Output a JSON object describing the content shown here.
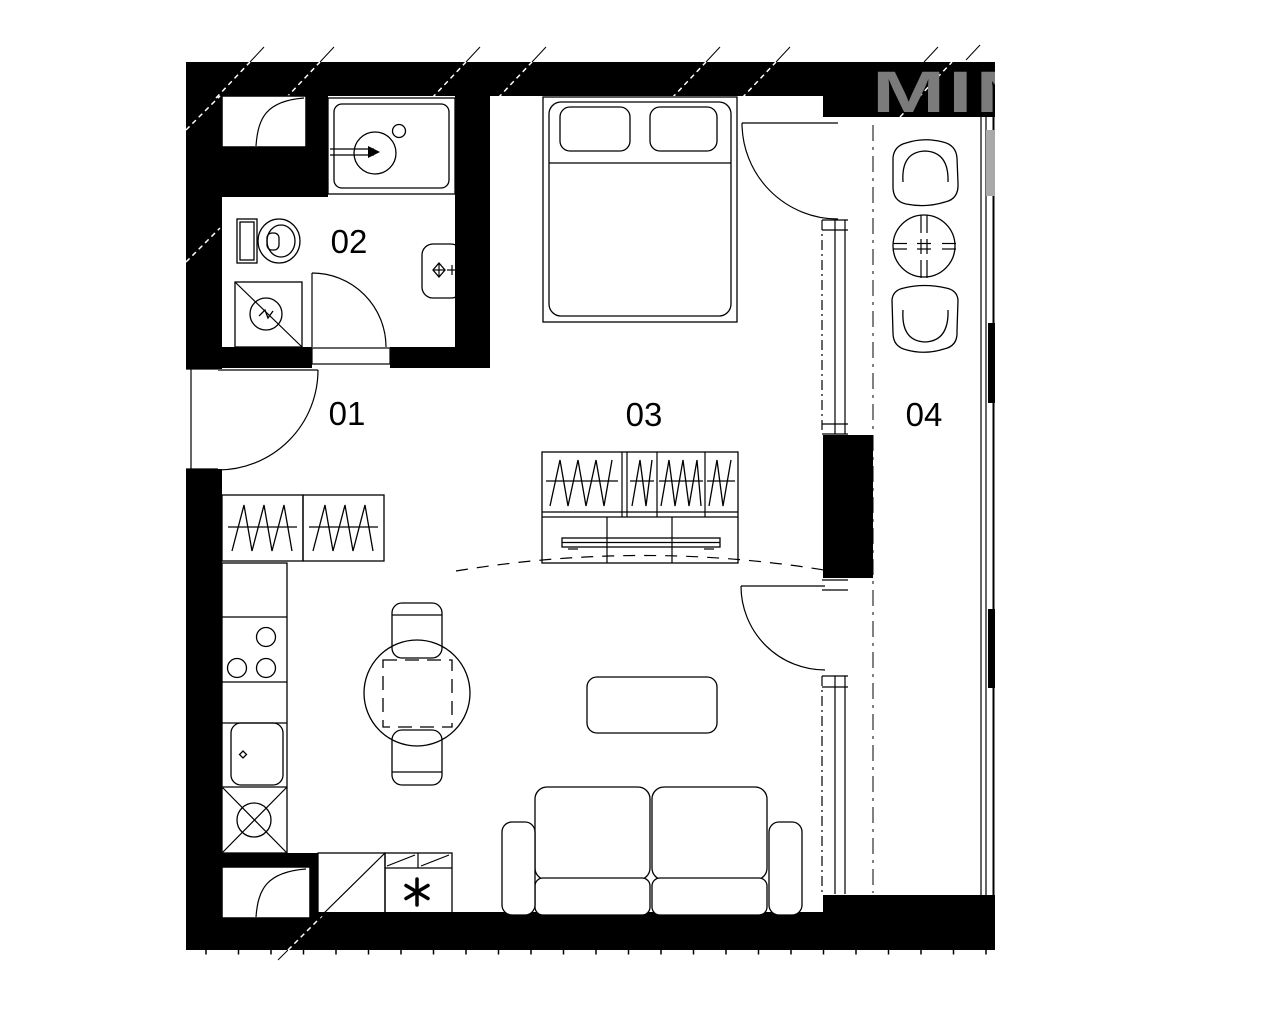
{
  "plan": {
    "rooms": [
      {
        "label": "01"
      },
      {
        "label": "02"
      },
      {
        "label": "03"
      },
      {
        "label": "04"
      }
    ],
    "watermark": {
      "text": "MIN"
    },
    "colors": {
      "wall": "#000000",
      "line": "#000000",
      "background": "#ffffff",
      "watermark_on_wall": "#7b7b7b",
      "watermark_fragment": "#a9a9a9"
    },
    "symbols": {
      "freezer-star-icon": "six-armed asterisk on fridge",
      "duct-shaft-icon": "rectangle with flue curve",
      "hanging-clothes-icon": "zigzag lines inside wardrobe",
      "shower-icon": "square with diagonal and drain circle",
      "washing-machine-icon": "square with diagonal cross and drum circle",
      "balcony-table-icon": "circle with crosshair ticks"
    }
  }
}
